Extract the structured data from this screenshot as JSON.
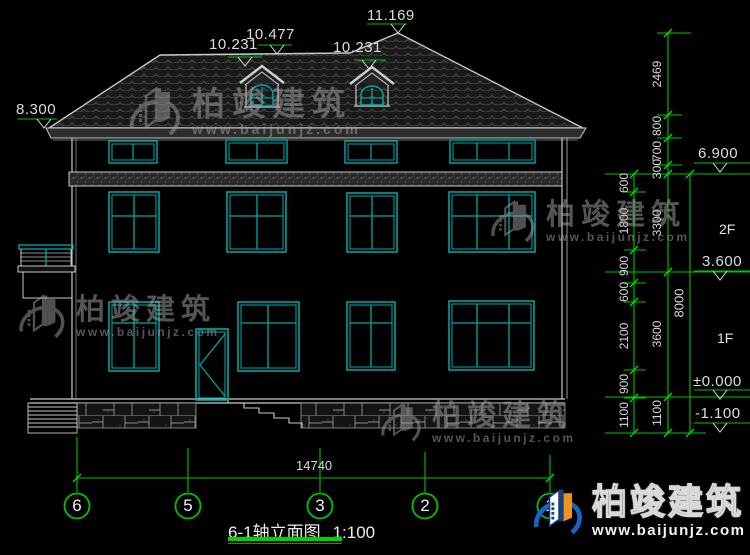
{
  "title": {
    "name": "6-1轴立面图",
    "scale": "1:100"
  },
  "levels": {
    "eave_left": "8.300",
    "dormer_eave_left": "10.231",
    "dormer_ridge": "10.477",
    "dormer_eave_right": "10.231",
    "ridge": "11.169",
    "attic": "6.900",
    "second": "3.600",
    "ground": "±0.000",
    "base": "-1.100"
  },
  "floors": {
    "second": "2F",
    "first": "1F"
  },
  "dims": {
    "inner": [
      "600",
      "1800",
      "900",
      "600",
      "2100",
      "900",
      "1100"
    ],
    "outer": [
      "2469",
      "800",
      "700",
      "300",
      "3300",
      "3600",
      "1100"
    ],
    "total_v": "8000",
    "total_h": "14740"
  },
  "axes": [
    "6",
    "5",
    "3",
    "2",
    "1"
  ],
  "watermark": {
    "brand": "柏竣建筑",
    "url": "www.baijunjz.com"
  },
  "logo": {
    "brand": "柏竣建筑",
    "url": "www.baijunjz.com"
  },
  "colors": {
    "line": "#c9c9c9",
    "window": "#00aaaa",
    "dimension": "#00c300",
    "background": "#000000"
  }
}
